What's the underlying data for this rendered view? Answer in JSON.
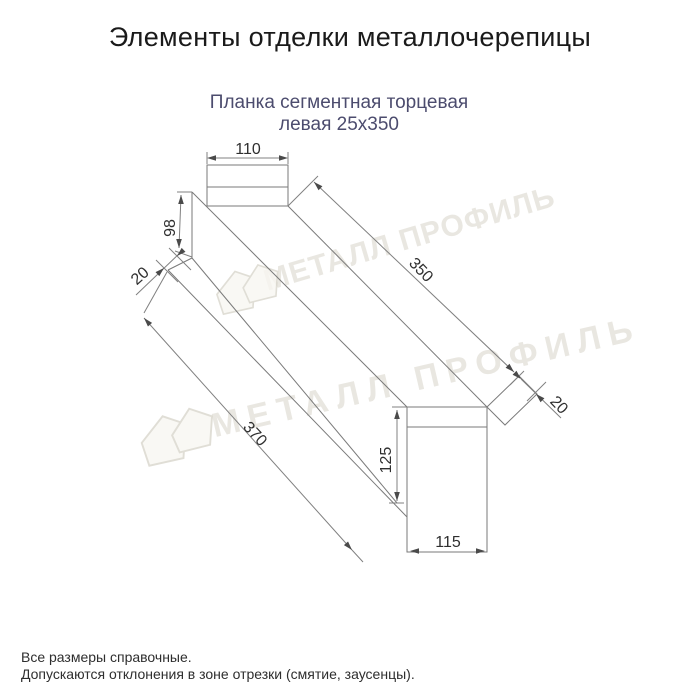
{
  "header": {
    "title": "Элементы отделки металлочерепицы"
  },
  "product": {
    "name_line1": "Планка сегментная торцевая",
    "name_line2": "левая 25х350"
  },
  "drawing": {
    "dimensions": {
      "top_width": "110",
      "left_height": "98",
      "left_hem": "20",
      "length_bottom_edge": "370",
      "length_top_edge": "350",
      "right_hem": "20",
      "end_height": "125",
      "end_width": "115"
    }
  },
  "watermark": {
    "brand": "МЕТАЛЛ ПРОФИЛЬ"
  },
  "footer": {
    "note1": "Все размеры справочные.",
    "note2": "Допускаются отклонения в зоне отрезки (смятие, заусенцы)."
  },
  "colors": {
    "title_text": "#1a1a1a",
    "subtitle_text": "#4c4c6e",
    "drawing_line": "#7a7a7a",
    "dimension_text": "#2f2f2f",
    "watermark": "#dcd9d0",
    "background": "#ffffff"
  }
}
